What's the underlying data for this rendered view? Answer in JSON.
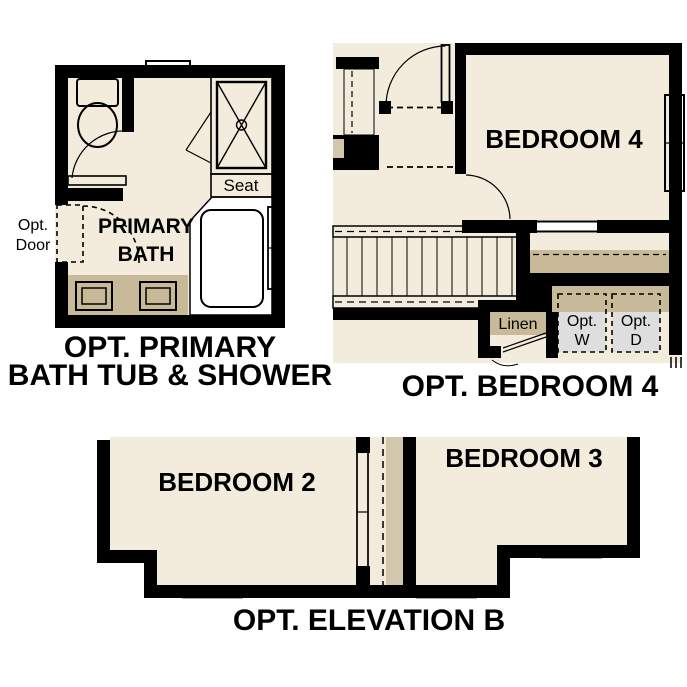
{
  "colors": {
    "background": "#ffffff",
    "floor_beige": "#f3ecdd",
    "wall_black": "#000000",
    "counter_tan": "#c8b998",
    "closet_strip_tan": "#d2c7ac",
    "fixture_blue": "#a9c7e6",
    "appliance_gray": "#dedede",
    "window_white": "#ffffff",
    "text": "#000000"
  },
  "plans": {
    "primary_bath": {
      "title": [
        "OPT. PRIMARY",
        "BATH TUB & SHOWER"
      ],
      "room_label": [
        "PRIMARY",
        "BATH"
      ],
      "opt_door_label": [
        "Opt.",
        "Door"
      ],
      "seat_label": "Seat"
    },
    "bedroom4": {
      "title": "OPT. BEDROOM 4",
      "room_label": "BEDROOM 4",
      "linen_label": "Linen",
      "optional_washer_label": [
        "Opt.",
        "W"
      ],
      "optional_dryer_label": [
        "Opt.",
        "D"
      ]
    },
    "elevation_b": {
      "title": "OPT. ELEVATION B",
      "bedroom2_label": "BEDROOM 2",
      "bedroom3_label": "BEDROOM 3"
    }
  }
}
